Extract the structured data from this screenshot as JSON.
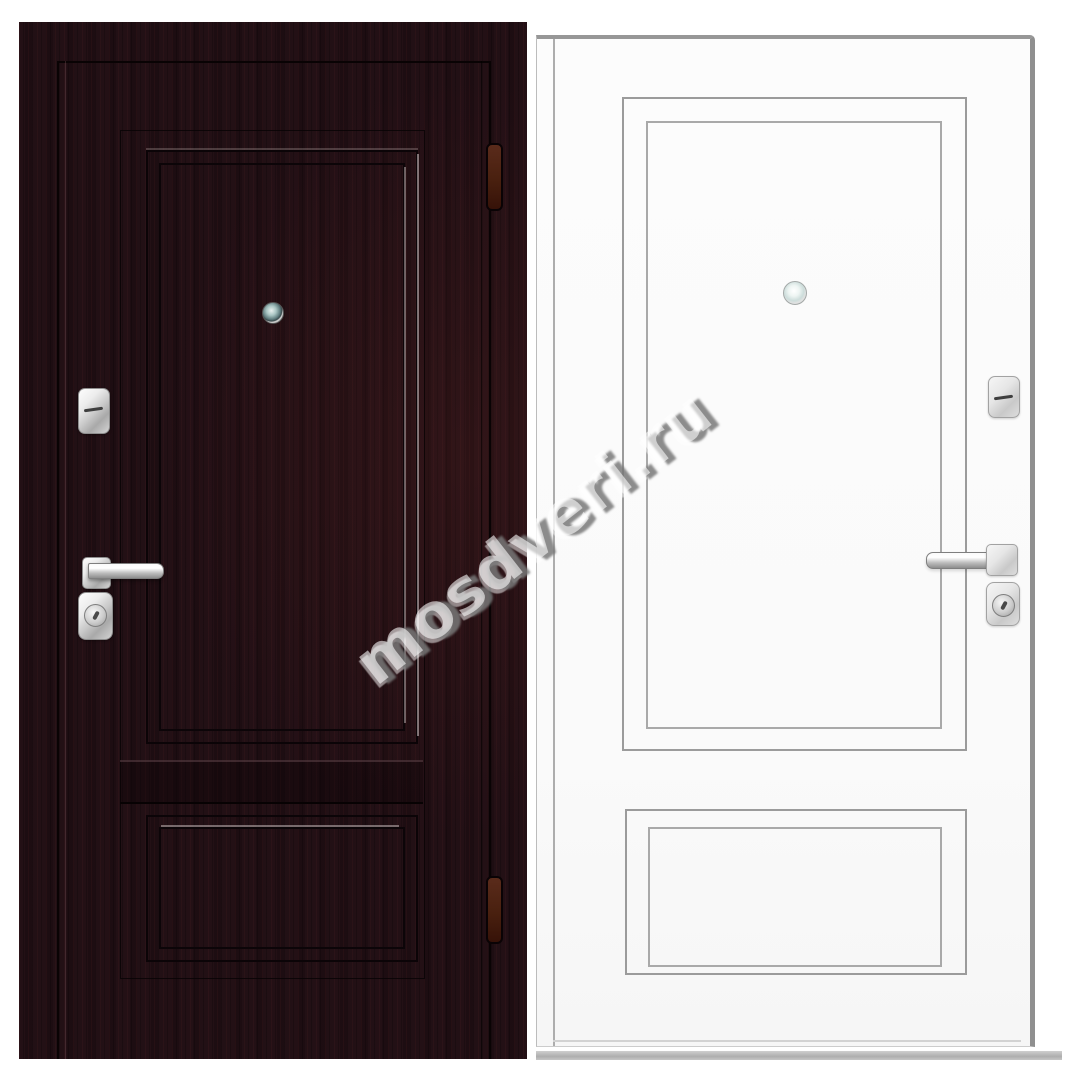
{
  "image": {
    "type": "product-photo",
    "subject": "steel entrance door shown from both sides: exterior dark wenge panel face and interior white panel face",
    "background": "#ffffff"
  },
  "watermark": {
    "text": "mosdveri.ru",
    "angle_deg": -38,
    "fill": "rgba(255,255,255,0.58)",
    "shadow": "#787878"
  },
  "colors": {
    "door_dark_base": "#1f0e13",
    "door_dark_molding_line": "#0b0407",
    "door_dark_molding_highlight": "#d6cbcb",
    "door_white_base": "#fbfbfb",
    "door_white_line": "#9b9b9b",
    "hardware_chrome": "#d4d4d4",
    "hinge_brown": "#49200f",
    "peephole_lens": "#5d7a7c",
    "floor_shadow": "#b5b5b5"
  },
  "left_door": {
    "side": "exterior",
    "parts": [
      "flip-lock-escutcheon",
      "lever-handle",
      "cylinder-lock",
      "peephole",
      "hinge-top",
      "hinge-bottom"
    ]
  },
  "right_door": {
    "side": "interior",
    "parts": [
      "flip-lock-escutcheon",
      "lever-handle",
      "cylinder-lock",
      "peephole"
    ]
  }
}
